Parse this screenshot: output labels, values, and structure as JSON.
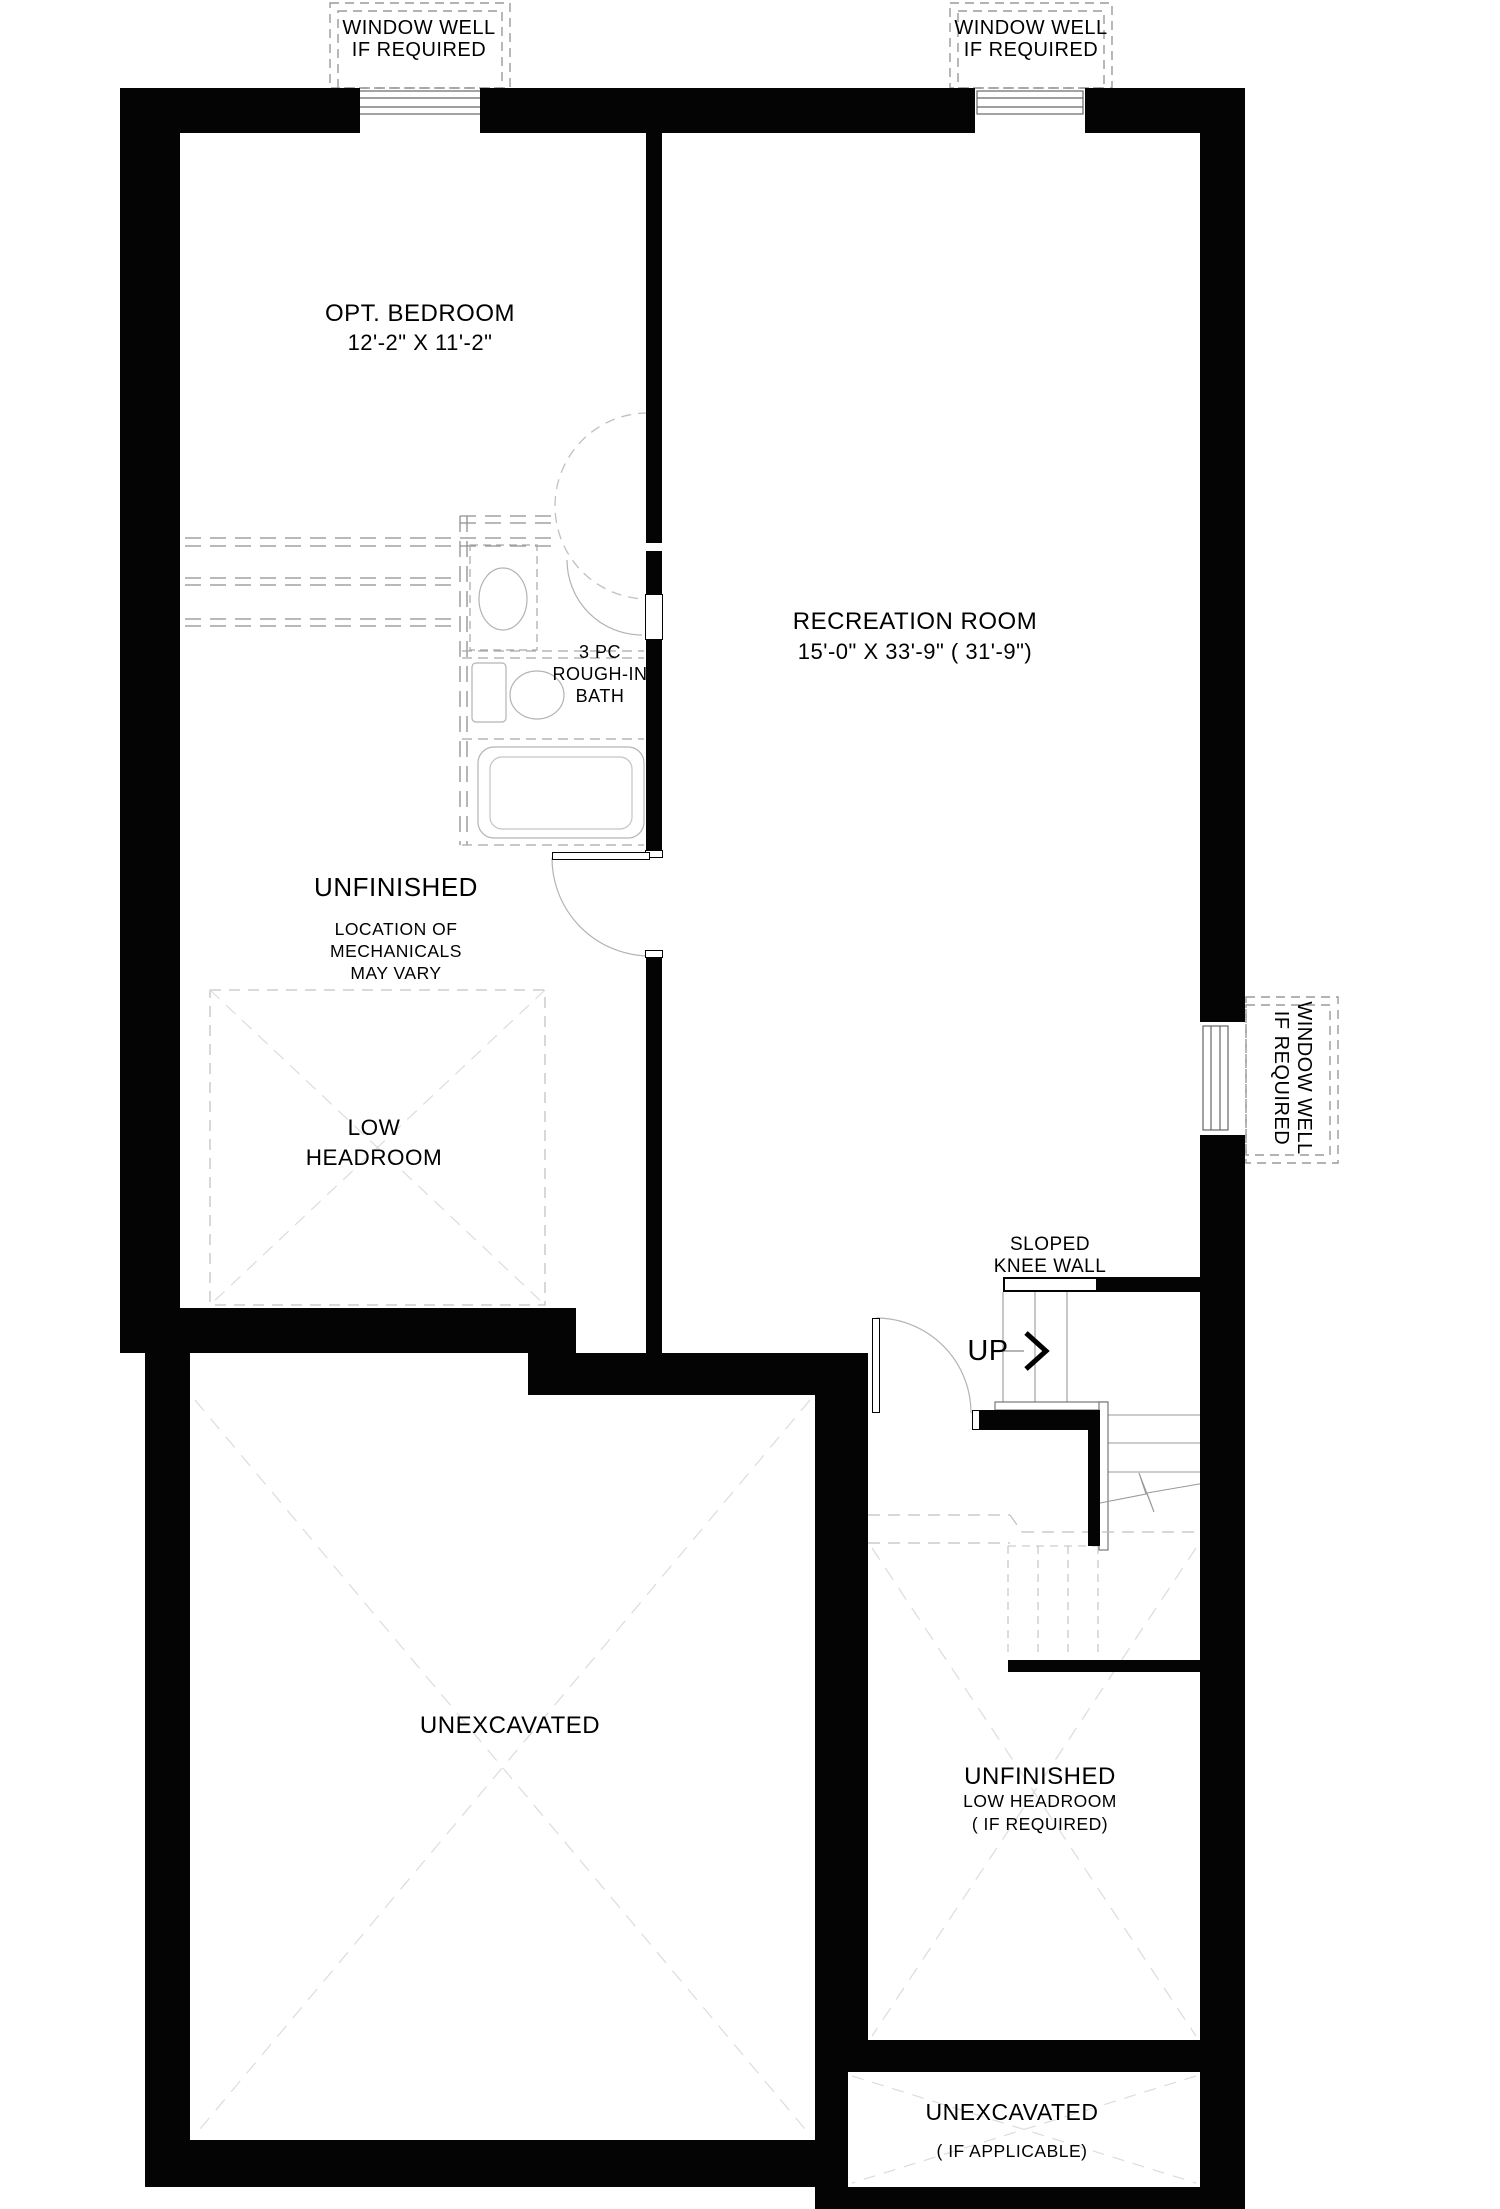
{
  "colors": {
    "wall": "#040404",
    "background": "#ffffff",
    "text": "#000000",
    "light_line": "#d9d9d9",
    "mid_line": "#b3b3b3",
    "dark_line": "#8c8c8c"
  },
  "labels": {
    "window_well_top_left": {
      "line1": "WINDOW WELL",
      "line2": "IF REQUIRED"
    },
    "window_well_top_right": {
      "line1": "WINDOW WELL",
      "line2": "IF REQUIRED"
    },
    "window_well_right": {
      "line1": "WINDOW WELL",
      "line2": "IF REQUIRED"
    },
    "opt_bedroom": {
      "name": "OPT. BEDROOM",
      "dims": "12'-2\" X 11'-2\""
    },
    "recreation_room": {
      "name": "RECREATION ROOM",
      "dims": "15'-0\" X 33'-9\" ( 31'-9\")"
    },
    "bath": {
      "line1": "3 PC",
      "line2": "ROUGH-IN",
      "line3": "BATH"
    },
    "unfinished_mechanicals": {
      "name": "UNFINISHED",
      "note_line1": "LOCATION OF",
      "note_line2": "MECHANICALS",
      "note_line3": "MAY VARY"
    },
    "low_headroom": {
      "line1": "LOW",
      "line2": "HEADROOM"
    },
    "sloped_knee_wall": {
      "line1": "SLOPED",
      "line2": "KNEE WALL"
    },
    "stairs": {
      "up": "UP"
    },
    "unexcavated_main": {
      "name": "UNEXCAVATED"
    },
    "unfinished_low_headroom": {
      "name": "UNFINISHED",
      "note_line1": "LOW HEADROOM",
      "note_line2": "( IF REQUIRED)"
    },
    "unexcavated_lower": {
      "name": "UNEXCAVATED",
      "note": "( IF APPLICABLE)"
    }
  }
}
